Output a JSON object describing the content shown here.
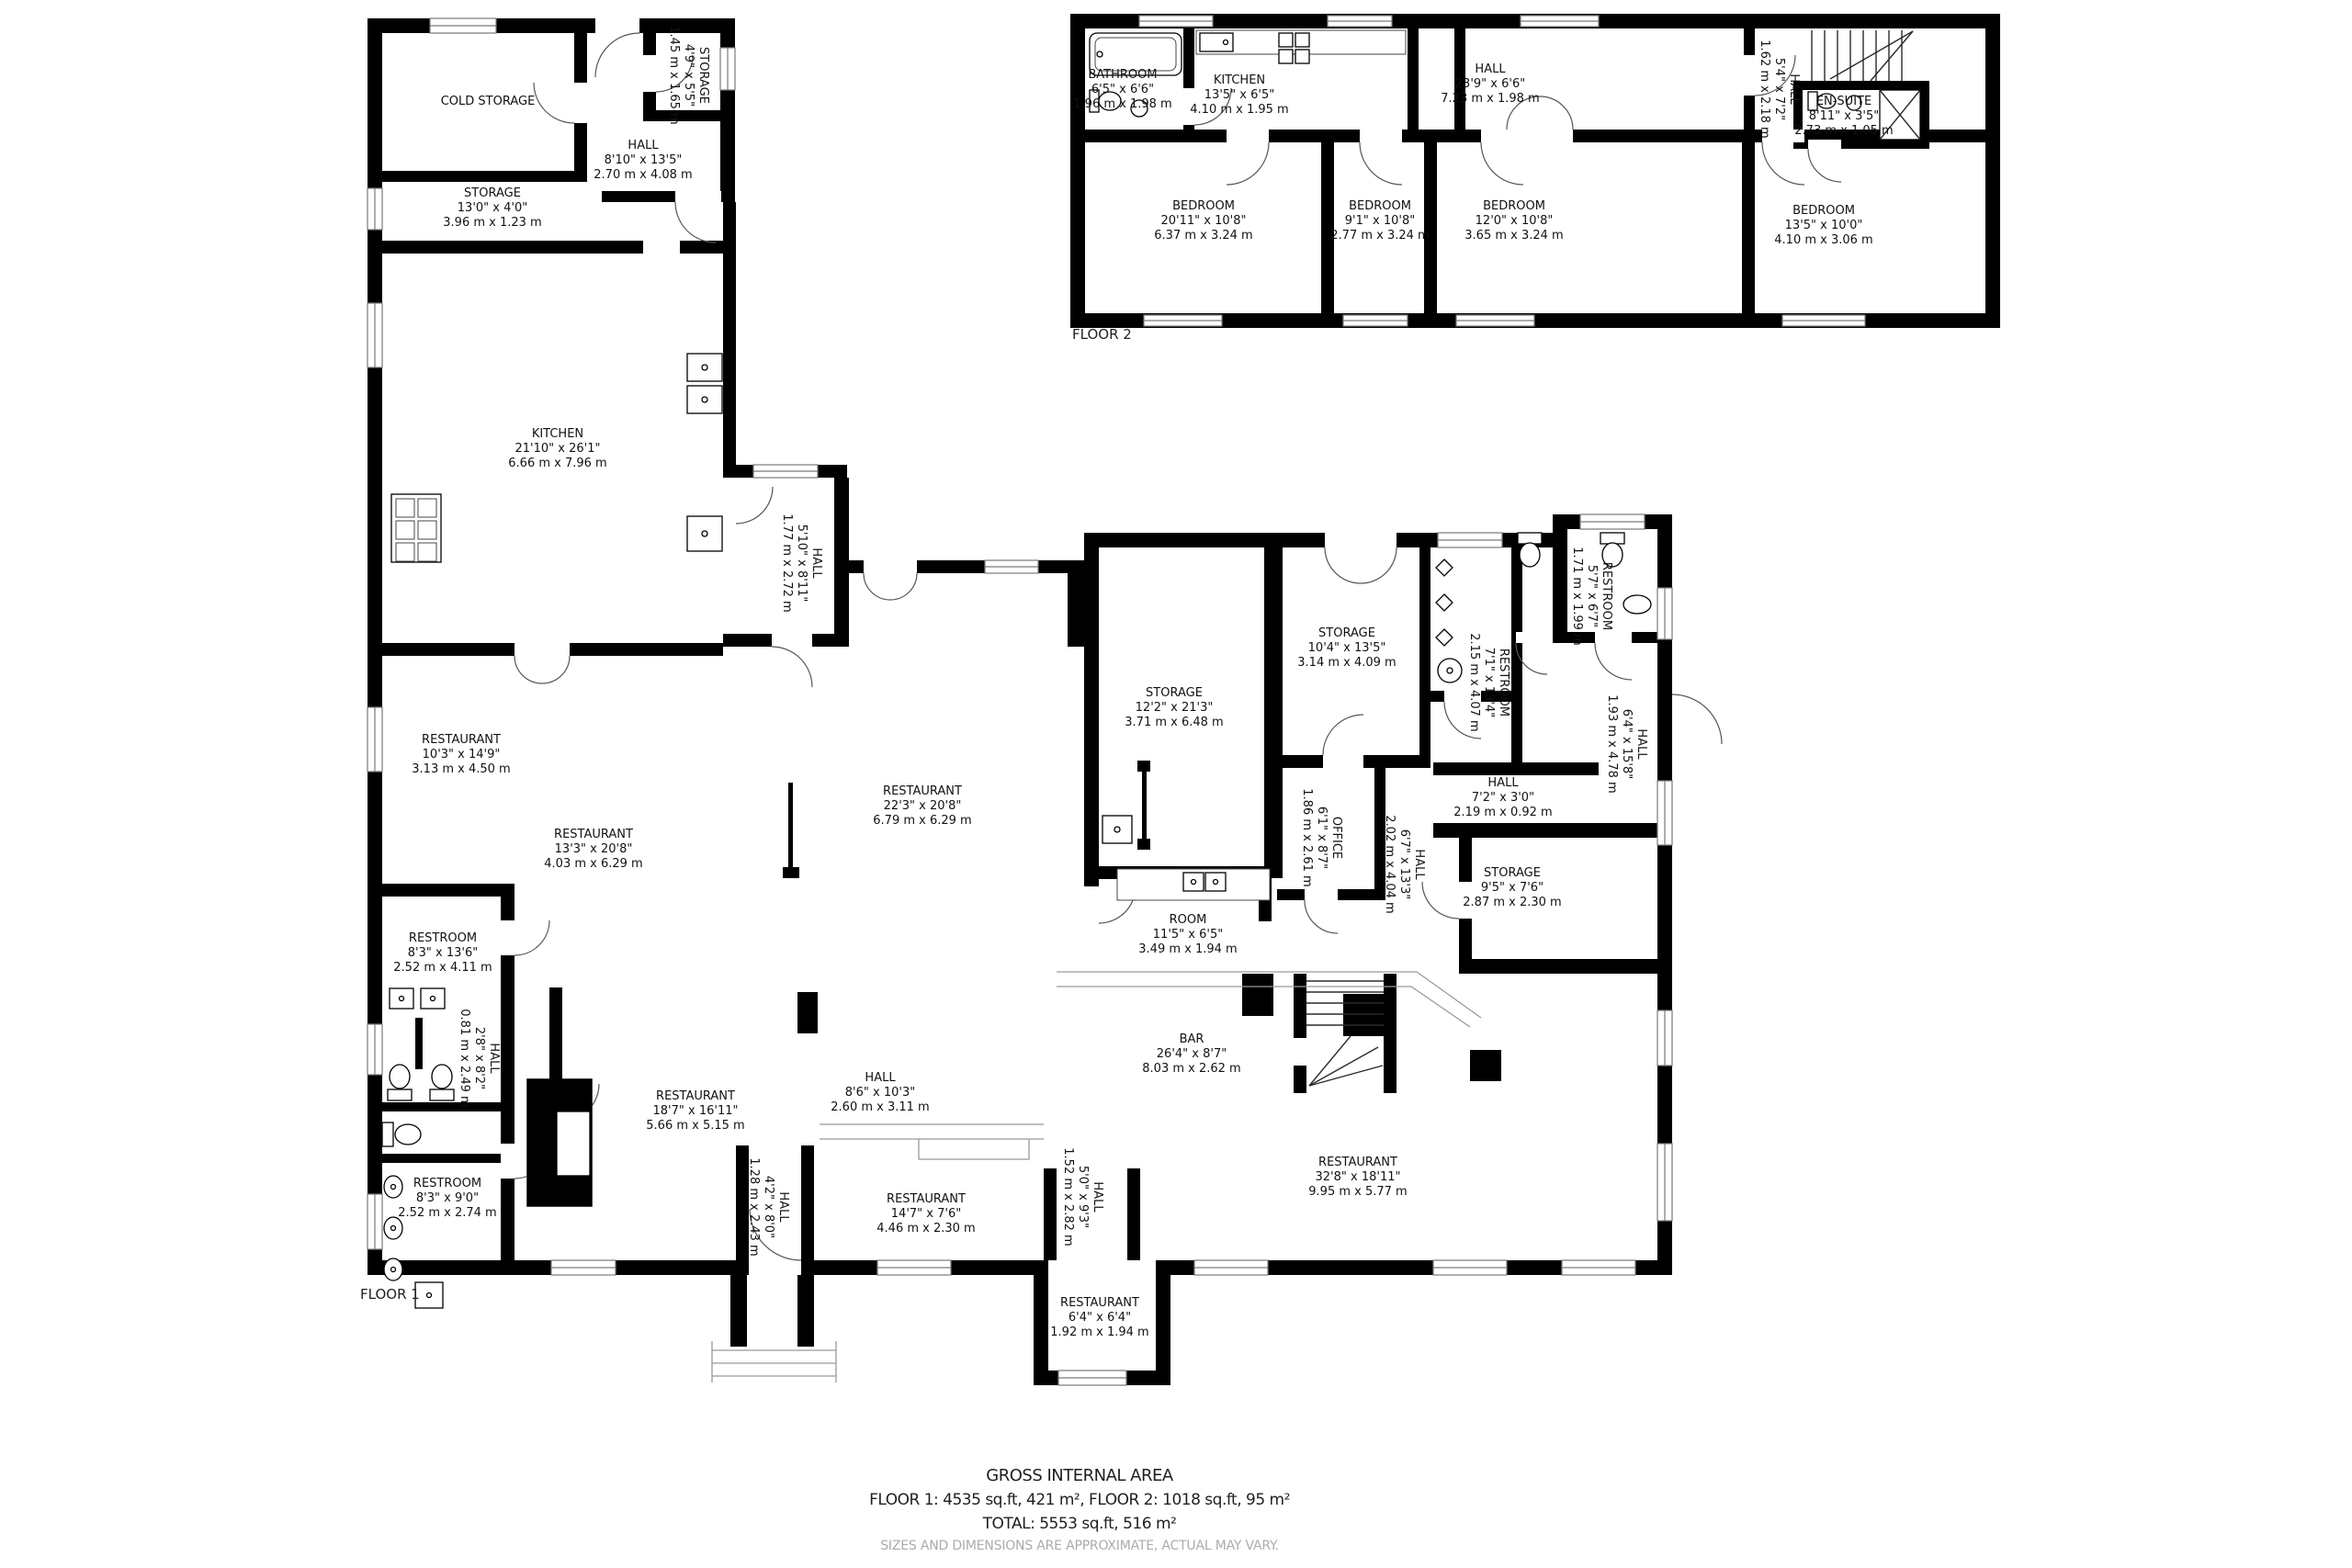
{
  "floor1": {
    "tag": "FLOOR 1",
    "rooms": [
      {
        "name": "COLD STORAGE",
        "ft": "",
        "m": ""
      },
      {
        "name": "STORAGE",
        "ft": "4'9\" x 5'5\"",
        "m": "1.45 m x 1.65 m"
      },
      {
        "name": "HALL",
        "ft": "8'10\" x 13'5\"",
        "m": "2.70 m x 4.08 m"
      },
      {
        "name": "STORAGE",
        "ft": "13'0\" x 4'0\"",
        "m": "3.96 m x 1.23 m"
      },
      {
        "name": "KITCHEN",
        "ft": "21'10\" x 26'1\"",
        "m": "6.66 m x 7.96 m"
      },
      {
        "name": "HALL",
        "ft": "5'10\" x 8'11\"",
        "m": "1.77 m x 2.72 m"
      },
      {
        "name": "RESTAURANT",
        "ft": "10'3\" x 14'9\"",
        "m": "3.13 m x 4.50 m"
      },
      {
        "name": "RESTAURANT",
        "ft": "13'3\" x 20'8\"",
        "m": "4.03 m x 6.29 m"
      },
      {
        "name": "RESTAURANT",
        "ft": "22'3\" x 20'8\"",
        "m": "6.79 m x 6.29 m"
      },
      {
        "name": "STORAGE",
        "ft": "12'2\" x 21'3\"",
        "m": "3.71 m x 6.48 m"
      },
      {
        "name": "STORAGE",
        "ft": "10'4\" x 13'5\"",
        "m": "3.14 m x 4.09 m"
      },
      {
        "name": "RESTROOM",
        "ft": "7'1\" x 13'4\"",
        "m": "2.15 m x 4.07 m"
      },
      {
        "name": "RESTROOM",
        "ft": "5'7\" x 6'7\"",
        "m": "1.71 m x 1.99 m"
      },
      {
        "name": "HALL",
        "ft": "6'4\" x 15'8\"",
        "m": "1.93 m x 4.78 m"
      },
      {
        "name": "HALL",
        "ft": "7'2\" x 3'0\"",
        "m": "2.19 m x 0.92 m"
      },
      {
        "name": "STORAGE",
        "ft": "9'5\" x 7'6\"",
        "m": "2.87 m x 2.30 m"
      },
      {
        "name": "OFFICE",
        "ft": "6'1\" x 8'7\"",
        "m": "1.86 m x 2.61 m"
      },
      {
        "name": "HALL",
        "ft": "6'7\" x 13'3\"",
        "m": "2.02 m x 4.04 m"
      },
      {
        "name": "ROOM",
        "ft": "11'5\" x 6'5\"",
        "m": "3.49 m x 1.94 m"
      },
      {
        "name": "RESTROOM",
        "ft": "8'3\" x 13'6\"",
        "m": "2.52 m x 4.11 m"
      },
      {
        "name": "HALL",
        "ft": "2'8\" x 8'2\"",
        "m": "0.81 m x 2.49 m"
      },
      {
        "name": "RESTROOM",
        "ft": "8'3\" x 9'0\"",
        "m": "2.52 m x 2.74 m"
      },
      {
        "name": "RESTAURANT",
        "ft": "18'7\" x 16'11\"",
        "m": "5.66 m x 5.15 m"
      },
      {
        "name": "HALL",
        "ft": "8'6\" x 10'3\"",
        "m": "2.60 m x 3.11 m"
      },
      {
        "name": "HALL",
        "ft": "4'2\" x 8'0\"",
        "m": "1.28 m x 2.43 m"
      },
      {
        "name": "RESTAURANT",
        "ft": "14'7\" x 7'6\"",
        "m": "4.46 m x 2.30 m"
      },
      {
        "name": "HALL",
        "ft": "5'0\" x 9'3\"",
        "m": "1.52 m x 2.82 m"
      },
      {
        "name": "BAR",
        "ft": "26'4\" x 8'7\"",
        "m": "8.03 m x 2.62 m"
      },
      {
        "name": "RESTAURANT",
        "ft": "32'8\" x 18'11\"",
        "m": "9.95 m x 5.77 m"
      },
      {
        "name": "RESTAURANT",
        "ft": "6'4\" x 6'4\"",
        "m": "1.92 m x 1.94 m"
      }
    ]
  },
  "floor2": {
    "tag": "FLOOR 2",
    "rooms": [
      {
        "name": "BATHROOM",
        "ft": "6'5\" x 6'6\"",
        "m": "1.96 m x 1.98 m"
      },
      {
        "name": "KITCHEN",
        "ft": "13'5\" x 6'5\"",
        "m": "4.10 m x 1.95 m"
      },
      {
        "name": "HALL",
        "ft": "23'9\" x 6'6\"",
        "m": "7.23 m x 1.98 m"
      },
      {
        "name": "HALL",
        "ft": "5'4\" x 7'2\"",
        "m": "1.62 m x 2.18 m"
      },
      {
        "name": "EN-SUITE",
        "ft": "8'11\" x 3'5\"",
        "m": "2.73 m x 1.05 m"
      },
      {
        "name": "BEDROOM",
        "ft": "20'11\" x 10'8\"",
        "m": "6.37 m x 3.24 m"
      },
      {
        "name": "BEDROOM",
        "ft": "9'1\" x 10'8\"",
        "m": "2.77 m x 3.24 m"
      },
      {
        "name": "BEDROOM",
        "ft": "12'0\" x 10'8\"",
        "m": "3.65 m x 3.24 m"
      },
      {
        "name": "BEDROOM",
        "ft": "13'5\" x 10'0\"",
        "m": "4.10 m x 3.06 m"
      }
    ]
  },
  "footer": {
    "title": "GROSS INTERNAL AREA",
    "line1": "FLOOR 1: 4535 sq.ft, 421 m², FLOOR 2: 1018 sq.ft, 95 m²",
    "line2": "TOTAL: 5553 sq.ft, 516 m²",
    "disclaimer": "SIZES AND DIMENSIONS ARE APPROXIMATE, ACTUAL MAY VARY."
  },
  "colors": {
    "wall": "#000000",
    "door_arc": "#555555",
    "window": "#7a7a7a",
    "text": "#1a1a1a",
    "muted": "#ababab"
  }
}
